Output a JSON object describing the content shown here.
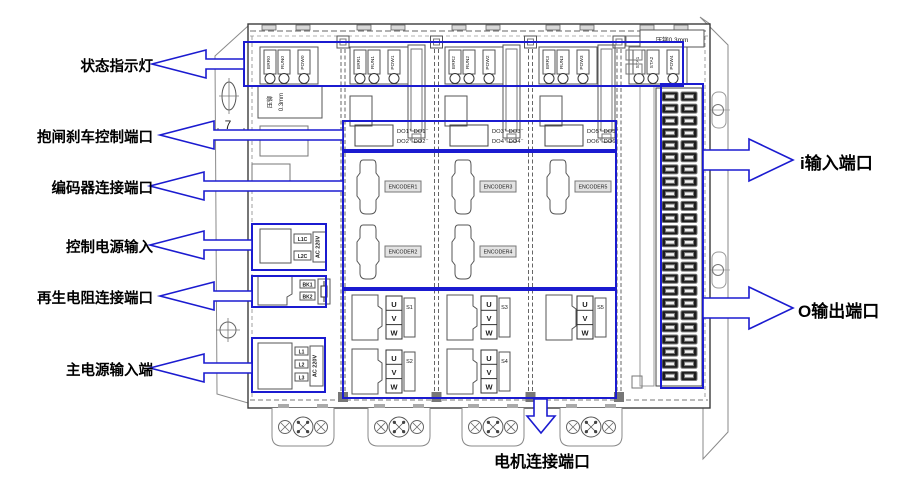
{
  "annotations": {
    "left": [
      {
        "label": "状态指示灯"
      },
      {
        "label": "抱闸刹车控制端口"
      },
      {
        "label": "编码器连接端口"
      },
      {
        "label": "控制电源输入"
      },
      {
        "label": "再生电阻连接端口"
      },
      {
        "label": "主电源输入端"
      }
    ],
    "right": [
      {
        "label": "i输入端口"
      },
      {
        "label": "O输出端口"
      }
    ],
    "bottom": {
      "label": "电机连接端口"
    }
  },
  "device": {
    "indicator_groups": [
      {
        "leds": [
          "ERR0",
          "RUN0",
          "POW0"
        ]
      },
      {
        "leds": [
          "ERR1",
          "RUN1",
          "POW1"
        ]
      },
      {
        "leds": [
          "ERR2",
          "RUN2",
          "POW2"
        ]
      },
      {
        "leds": [
          "ERR3",
          "RUN3",
          "POW3"
        ]
      },
      {
        "leds": [
          "STA1",
          "STA2",
          "POW4"
        ]
      }
    ],
    "stamp_left": {
      "line1": "压铆",
      "line2": "0.3mm"
    },
    "stamp_top_right": "压铆0.3mm",
    "dimension": "7",
    "power": {
      "control": {
        "terminals": [
          "L1C",
          "L2C"
        ],
        "rating": "AC 220V"
      },
      "regen": {
        "terminals": [
          "BK1",
          "BK2"
        ]
      },
      "main": {
        "terminals": [
          "L1",
          "L2",
          "L3"
        ],
        "rating": "AC 220V"
      }
    },
    "axes": [
      {
        "do_lines": [
          "DO1⁺ DO1⁻",
          "DO2⁺ DO2⁻"
        ],
        "encoders": [
          "ENCODER1",
          "ENCODER2"
        ],
        "motor_ids": [
          "S1",
          "S2"
        ]
      },
      {
        "do_lines": [
          "DO3⁺ DO3⁻",
          "DO4⁺ DO4⁻"
        ],
        "encoders": [
          "ENCODER3",
          "ENCODER4"
        ],
        "motor_ids": [
          "S3",
          "S4"
        ]
      },
      {
        "do_lines": [
          "DO5⁺ DO5⁻",
          "DO6⁺ DO6⁻"
        ],
        "encoders": [
          "ENCODER5"
        ],
        "motor_ids": [
          "S5"
        ]
      }
    ],
    "motor_phases": [
      "U",
      "V",
      "W"
    ],
    "io_terminal": {
      "rows": 24,
      "columns": 2
    },
    "colors": {
      "annotation_blue": "#1b1bd0",
      "outline_dark": "#3c3c3c",
      "outline_gray": "#8a8a8a"
    }
  }
}
